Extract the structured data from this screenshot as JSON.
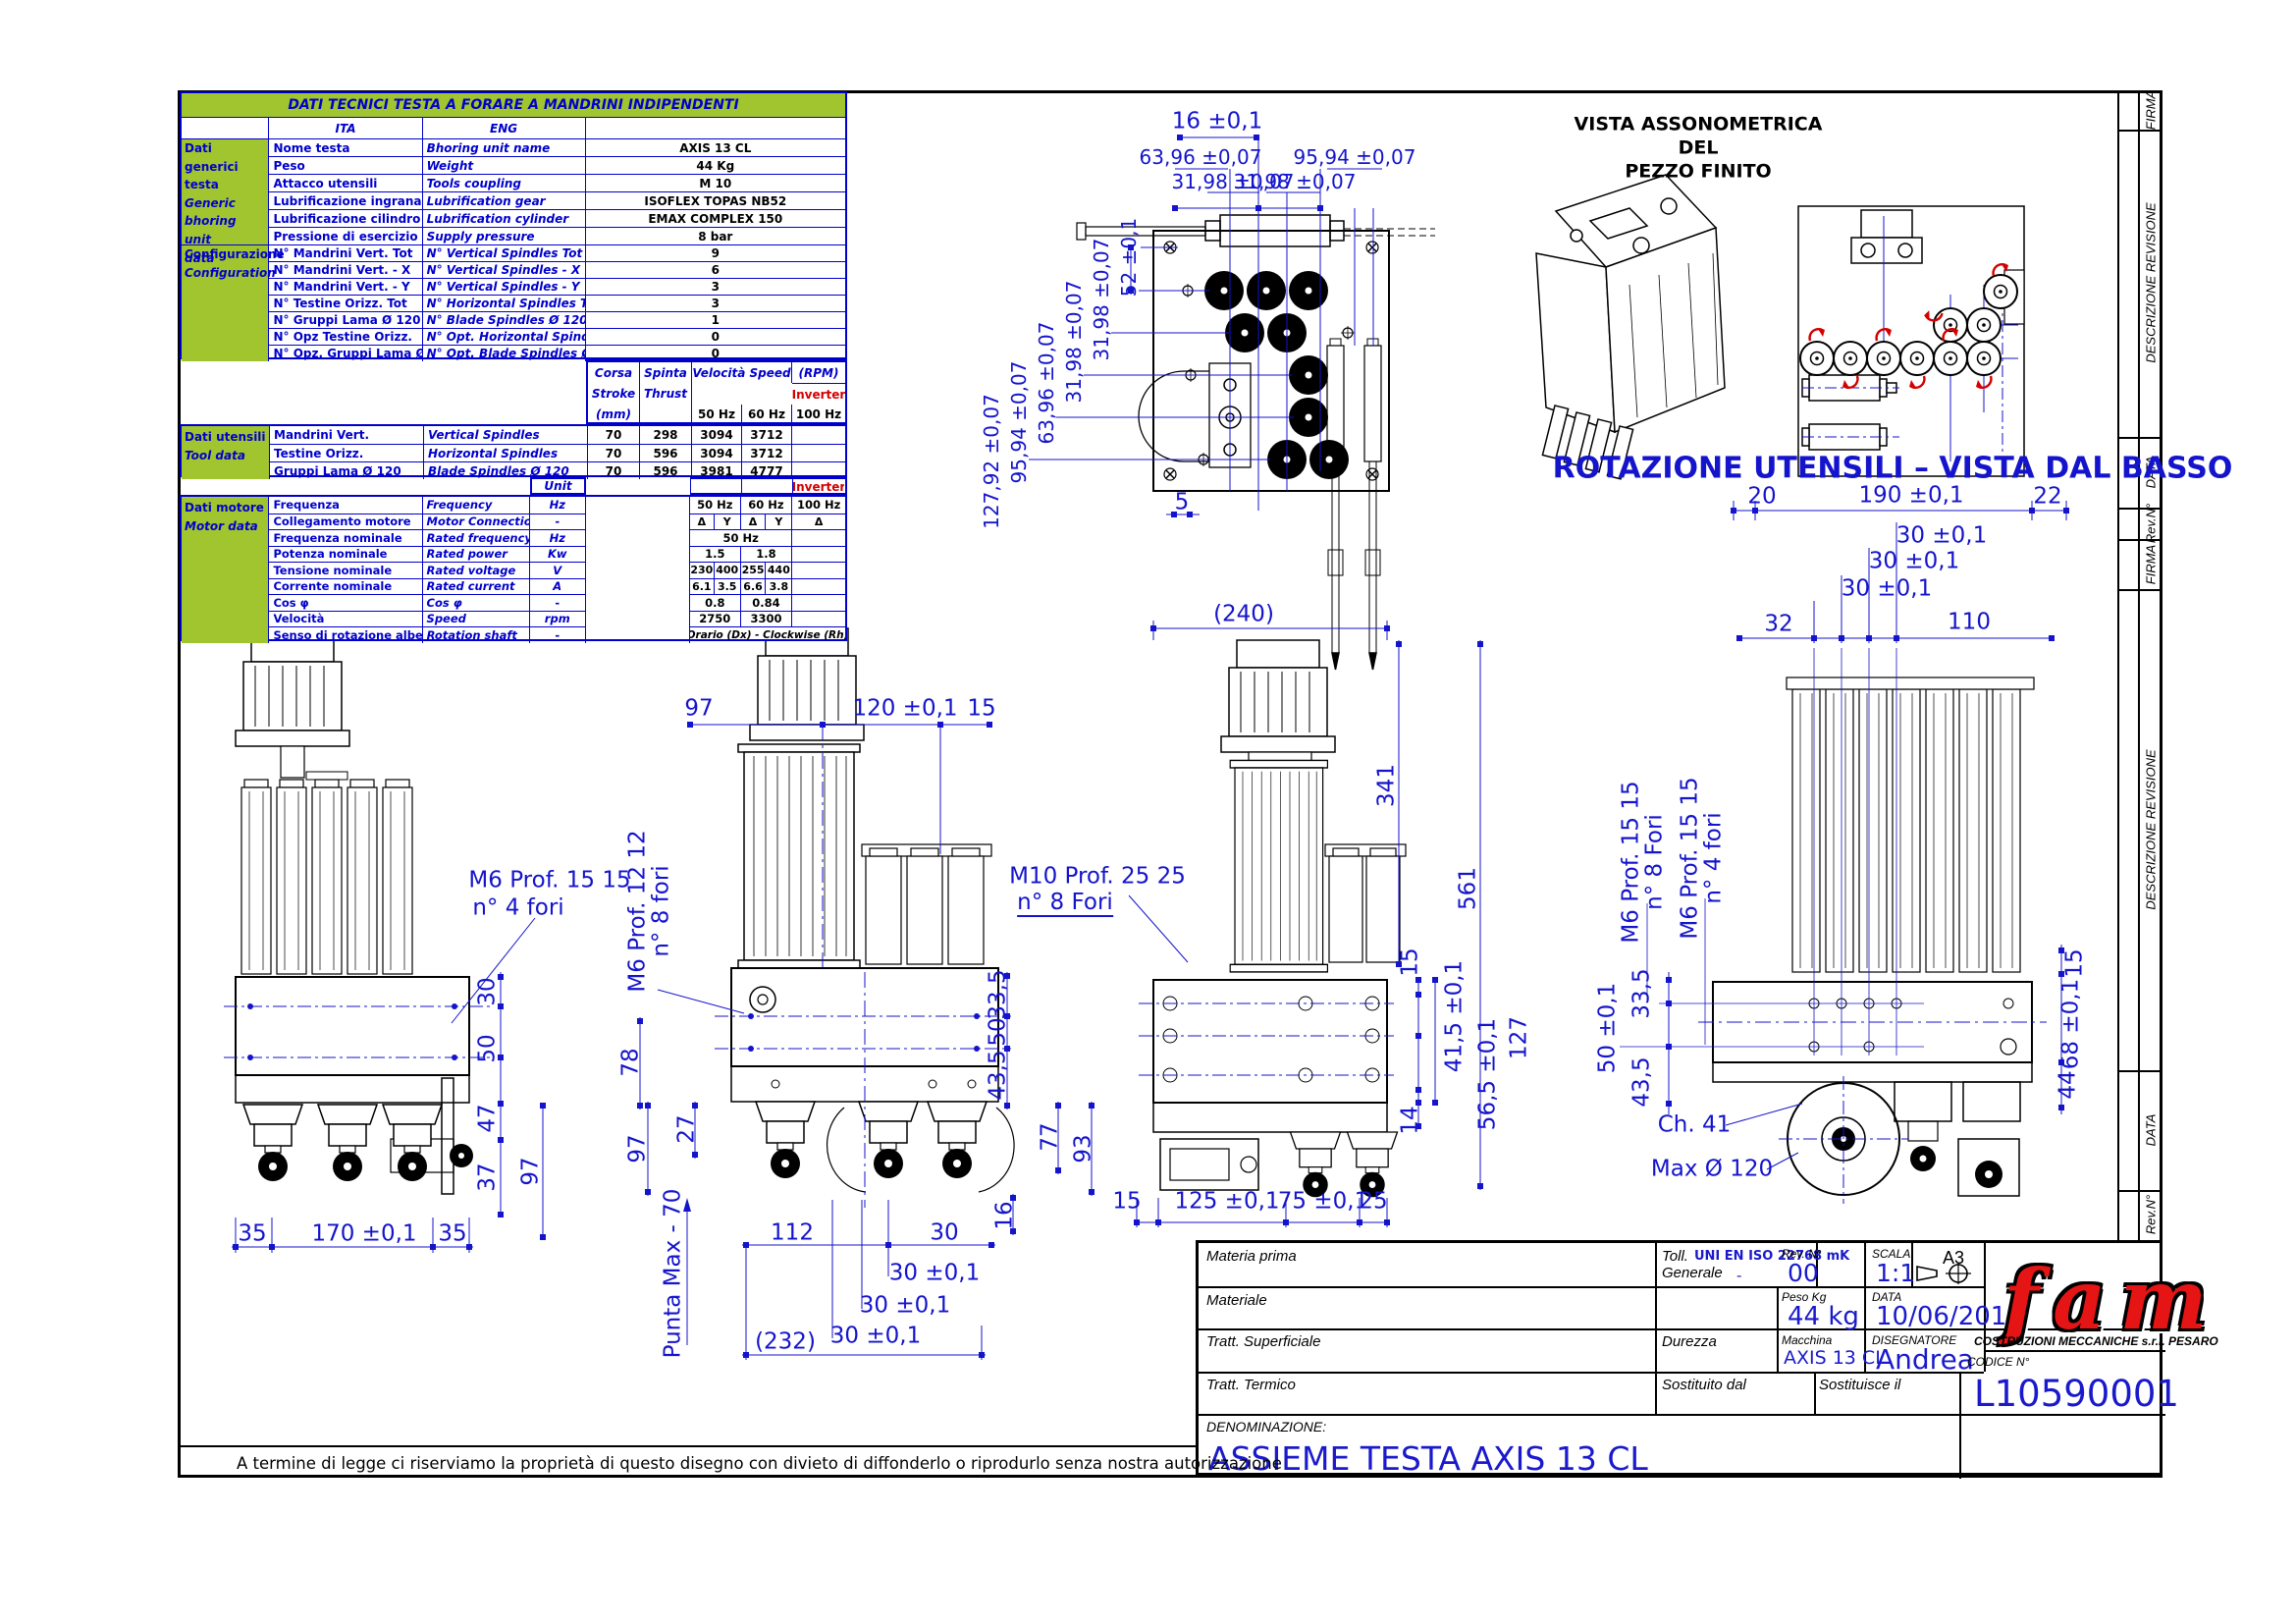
{
  "colors": {
    "table_blue": "#0000cc",
    "dim_blue": "#1414cc",
    "green": "#a1c52f",
    "red": "#d40000",
    "logo_red": "#e51515"
  },
  "sheet": {
    "disclaimer": "A termine di legge ci riserviamo la proprietà di questo disegno con divieto di diffonderlo o riprodurlo senza nostra autorizzazione",
    "strip": {
      "firma": "FIRMA",
      "descrizione": "DESCRIZIONE REVISIONE",
      "data": "DATA",
      "rev": "Rev.N°"
    }
  },
  "table": {
    "title": "DATI TECNICI TESTA A FORARE A MANDRINI INDIPENDENTI",
    "ita": "ITA",
    "eng": "ENG",
    "generic": {
      "l1": "Dati generici",
      "l2": "testa",
      "l3": "Generic",
      "l4": "bhoring unit",
      "l5": "data",
      "rows": [
        {
          "i": "Nome testa",
          "e": "Bhoring unit name",
          "v": "AXIS 13 CL"
        },
        {
          "i": "Peso",
          "e": "Weight",
          "v": "44 Kg"
        },
        {
          "i": "Attacco utensili",
          "e": "Tools coupling",
          "v": "M 10"
        },
        {
          "i": "Lubrificazione ingranaggi",
          "e": "Lubrification gear",
          "v": "ISOFLEX TOPAS NB52"
        },
        {
          "i": "Lubrificazione cilindro",
          "e": "Lubrification cylinder",
          "v": "EMAX COMPLEX 150"
        },
        {
          "i": "Pressione di esercizio",
          "e": "Supply pressure",
          "v": "8 bar"
        }
      ]
    },
    "config": {
      "l1": "Configurazione",
      "l2": "Configuration",
      "rows": [
        {
          "i": "N° Mandrini Vert. Tot",
          "e": "N° Vertical Spindles Tot",
          "v": "9"
        },
        {
          "i": "N° Mandrini Vert. - X",
          "e": "N° Vertical Spindles - X",
          "v": "6"
        },
        {
          "i": "N° Mandrini Vert. - Y",
          "e": "N° Vertical Spindles - Y",
          "v": "3"
        },
        {
          "i": "N° Testine Orizz. Tot",
          "e": "N° Horizontal Spindles Tot",
          "v": "3"
        },
        {
          "i": "N° Gruppi Lama Ø 120",
          "e": "N° Blade Spindles Ø 120",
          "v": "1"
        },
        {
          "i": "N° Opz Testine Orizz.",
          "e": "N° Opt. Horizontal Spindles",
          "v": "0"
        },
        {
          "i": "N° Opz. Gruppi Lama Ø 120",
          "e": "N° Opt. Blade Spindles Ø 120",
          "v": "0"
        }
      ]
    },
    "toolhdr": {
      "c1": "Corsa",
      "c2": "Stroke",
      "c3": "(mm)",
      "s1": "Spinta",
      "s2": "Thrust",
      "s3": "(N)",
      "v": "Velocità Speed",
      "rpm": "(RPM)",
      "inv": "Inverter",
      "h50": "50 Hz",
      "h60": "60 Hz",
      "h100": "100 Hz"
    },
    "tool": {
      "l1": "Dati utensili",
      "l2": "Tool data",
      "rows": [
        {
          "i": "Mandrini Vert.",
          "e": "Vertical Spindles",
          "c": "70",
          "s": "298",
          "v50": "3094",
          "v60": "3712",
          "inv": ""
        },
        {
          "i": "Testine Orizz.",
          "e": "Horizontal Spindles",
          "c": "70",
          "s": "596",
          "v50": "3094",
          "v60": "3712",
          "inv": ""
        },
        {
          "i": "Gruppi Lama Ø 120",
          "e": "Blade Spindles Ø 120",
          "c": "70",
          "s": "596",
          "v50": "3981",
          "v60": "4777",
          "inv": ""
        }
      ]
    },
    "unit": "Unit",
    "motor": {
      "l1": "Dati motore",
      "l2": "Motor data",
      "inv": "Inverter",
      "rows": [
        {
          "i": "Frequenza",
          "e": "Frequency",
          "u": "Hz",
          "a": "50 Hz",
          "b": "60 Hz",
          "c": "100 Hz"
        },
        {
          "i": "Collegamento motore",
          "e": "Motor Connection",
          "u": "-",
          "d1": "Δ",
          "y1": "Y",
          "d2": "Δ",
          "y2": "Y",
          "d3": "Δ"
        },
        {
          "i": "Frequenza nominale",
          "e": "Rated frequency",
          "u": "Hz",
          "span": "50 Hz"
        },
        {
          "i": "Potenza nominale",
          "e": "Rated power",
          "u": "Kw",
          "a": "1.5",
          "b": "1.8",
          "c": ""
        },
        {
          "i": "Tensione nominale",
          "e": "Rated voltage",
          "u": "V",
          "d1": "230",
          "y1": "400",
          "d2": "255",
          "y2": "440",
          "d3": ""
        },
        {
          "i": "Corrente nominale",
          "e": "Rated current",
          "u": "A",
          "d1": "6.1",
          "y1": "3.5",
          "d2": "6.6",
          "y2": "3.8",
          "d3": ""
        },
        {
          "i": "Cos φ",
          "e": "Cos φ",
          "u": "-",
          "a": "0.8",
          "b": "0.84",
          "c": ""
        },
        {
          "i": "Velocità",
          "e": "Speed",
          "u": "rpm",
          "a": "2750",
          "b": "3300",
          "c": ""
        },
        {
          "i": "Senso di rotazione albero",
          "e": "Rotation shaft",
          "u": "-",
          "span": "Orario (Dx) - Clockwise (Rh)"
        }
      ]
    }
  },
  "views": {
    "iso": {
      "t1": "VISTA ASSONOMETRICA",
      "t2": "DEL",
      "t3": "PEZZO FINITO"
    },
    "rot": {
      "title": "ROTAZIONE UTENSILI – VISTA DAL BASSO"
    },
    "plan": {
      "d16": "16 ±0,1",
      "d6396a": "63,96 ±0,07",
      "d9594a": "95,94 ±0,07",
      "d3198a": "31,98 ±0,07",
      "d3198b": "31,98 ±0,07",
      "d52": "52 ±0,1",
      "d3198c": "31,98 ±0,07",
      "d3198d": "31,98 ±0,07",
      "d6396b": "63,96 ±0,07",
      "d9594b": "95,94 ±0,07",
      "d12792": "127,92 ±0,07",
      "d5": "5"
    },
    "v1": {
      "note1": "M6   Prof. 15 15",
      "note2": "n° 4 fori",
      "d30": "30",
      "d50": "50",
      "d47": "47",
      "d37": "37",
      "d97": "97",
      "d35a": "35",
      "d170": "170 ±0,1",
      "d35b": "35"
    },
    "v2": {
      "note1": "M6   Prof. 12 12",
      "note2": "n° 8 fori",
      "dt97": "97",
      "dt120": "120 ±0,1",
      "dt15": "15",
      "d78": "78",
      "d27": "27",
      "d97": "97",
      "d335": "33,5",
      "d50": "50",
      "d435": "43,5",
      "d77": "77",
      "d93": "93",
      "d16": "16",
      "d112": "112",
      "d30": "30",
      "d30a": "30 ±0,1",
      "d30b": "30 ±0,1",
      "d30c": "30 ±0,1",
      "d232": "(232)",
      "punta": "Punta Max - 70"
    },
    "v3": {
      "note1": "M10   Prof. 25 25",
      "note2": "n° 8 Fori",
      "d240": "(240)",
      "d341": "341",
      "d561": "561",
      "d15": "15",
      "d415": "41,5 ±0,1",
      "d565": "56,5 ±0,1",
      "d127": "127",
      "d14": "14",
      "db15": "15",
      "d125": "125 ±0,1",
      "d75": "75 ±0,1",
      "d25": "25"
    },
    "v4": {
      "noteA1": "M6   Prof. 15 15",
      "noteA2": "n° 8 Fori",
      "noteB1": "M6   Prof. 15 15",
      "noteB2": "n° 4 fori",
      "d20": "20",
      "d190": "190 ±0,1",
      "d22": "22",
      "d30a": "30 ±0,1",
      "d30b": "30 ±0,1",
      "d30c": "30 ±0,1",
      "d32": "32",
      "d110": "110",
      "d335": "33,5",
      "d50": "50 ±0,1",
      "d435": "43,5",
      "dch": "Ch. 41",
      "dmax": "Max Ø 120",
      "d15": "15",
      "d68": "68 ±0,1",
      "d44": "44"
    }
  },
  "tb": {
    "materia": "Materia prima",
    "materiale": "Materiale",
    "tratt_sup": "Tratt. Superficiale",
    "tratt_term": "Tratt. Termico",
    "toll1": "Toll.",
    "toll2": "Generale",
    "toll_v": "UNI EN ISO 22768 mK",
    "toll_d": "-",
    "rev_l": "Rev. N°",
    "rev_v": "00",
    "scala_l": "SCALA",
    "scala_v": "1:1",
    "fmt": "A3",
    "peso_l": "Peso Kg",
    "peso_v": "44 kg",
    "data_l": "DATA",
    "data_v": "10/06/2010",
    "durezza": "Durezza",
    "macch_l": "Macchina",
    "macch_v": "AXIS 13 CL",
    "dis_l": "DISEGNATORE",
    "dis_v": "Andrea",
    "sost1": "Sostituito dal",
    "sost2": "Sostituisce il",
    "company": "COSTRUZIONI MECCANICHE s.r.l. PESARO",
    "cod_l": "CODICE N°",
    "cod_v": "L10590001",
    "den_l": "DENOMINAZIONE:",
    "den_v": "ASSIEME TESTA AXIS 13 CL",
    "logo": "fam"
  }
}
